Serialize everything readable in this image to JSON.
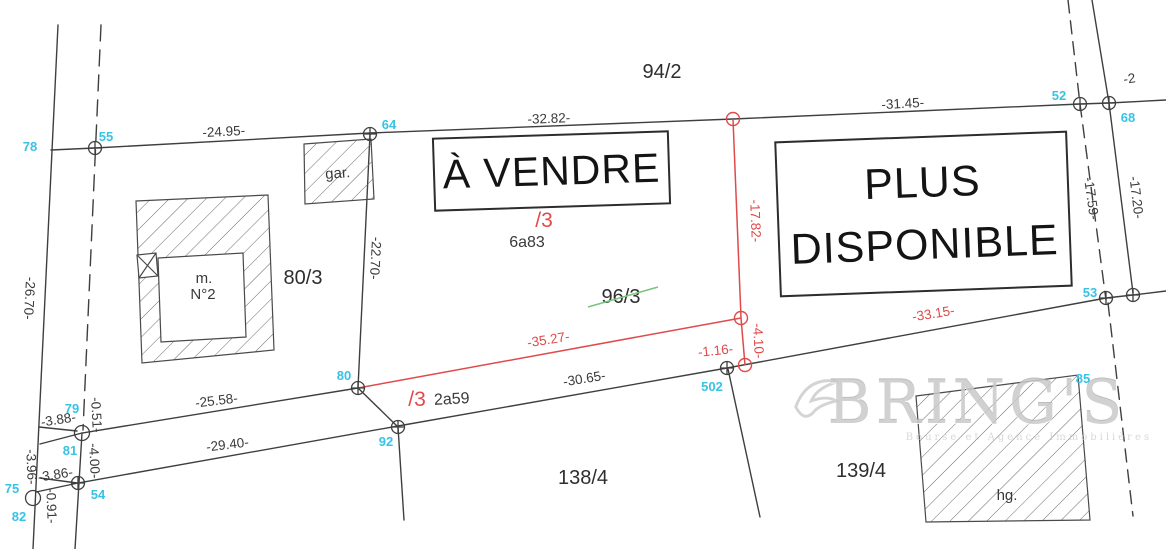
{
  "signs": {
    "for_sale": "À VENDRE",
    "unavailable": "PLUS DISPONIBLE"
  },
  "watermark": {
    "brand": "BRING'S",
    "tagline": "Bourse et Agence Immobilières"
  },
  "parcels": [
    {
      "t": "94/2",
      "x": 662,
      "y": 78
    },
    {
      "t": "80/3",
      "x": 303,
      "y": 284
    },
    {
      "t": "96/3",
      "x": 621,
      "y": 303
    },
    {
      "t": "138/4",
      "x": 583,
      "y": 484
    },
    {
      "t": "139/4",
      "x": 861,
      "y": 477
    }
  ],
  "area_labels": [
    {
      "t": "6a83",
      "x": 527,
      "y": 247
    },
    {
      "t": "2a59",
      "x": 452,
      "y": 404,
      "r": -3
    }
  ],
  "lot_labels": [
    {
      "t": "/3",
      "x": 544,
      "y": 227,
      "s": 22
    },
    {
      "t": "/3",
      "x": 417,
      "y": 406,
      "s": 20
    }
  ],
  "building_labels": [
    {
      "t": "gar.",
      "x": 338,
      "y": 178,
      "r": -4
    },
    {
      "t": "m.",
      "x": 204,
      "y": 283
    },
    {
      "t": "N°2",
      "x": 203,
      "y": 299
    },
    {
      "t": "hg.",
      "x": 1007,
      "y": 500
    }
  ],
  "survey_points": [
    {
      "t": "78",
      "x": 30,
      "y": 151
    },
    {
      "t": "55",
      "x": 106,
      "y": 141
    },
    {
      "t": "64",
      "x": 389,
      "y": 129
    },
    {
      "t": "52",
      "x": 1059,
      "y": 100
    },
    {
      "t": "68",
      "x": 1128,
      "y": 122
    },
    {
      "t": "53",
      "x": 1090,
      "y": 297
    },
    {
      "t": "85",
      "x": 1083,
      "y": 383
    },
    {
      "t": "80",
      "x": 344,
      "y": 380
    },
    {
      "t": "92",
      "x": 386,
      "y": 446
    },
    {
      "t": "502",
      "x": 712,
      "y": 391
    },
    {
      "t": "79",
      "x": 72,
      "y": 413
    },
    {
      "t": "81",
      "x": 70,
      "y": 455
    },
    {
      "t": "75",
      "x": 12,
      "y": 493
    },
    {
      "t": "54",
      "x": 98,
      "y": 499
    },
    {
      "t": "82",
      "x": 19,
      "y": 521
    }
  ],
  "measurements": {
    "black": [
      {
        "t": "-24.95-",
        "x": 224,
        "y": 136,
        "r": -3
      },
      {
        "t": "-32.82-",
        "x": 549,
        "y": 123,
        "r": -2
      },
      {
        "t": "-31.45-",
        "x": 903,
        "y": 108,
        "r": -3
      },
      {
        "t": "-22.70-",
        "x": 371,
        "y": 258,
        "r": 93
      },
      {
        "t": "-26.70-",
        "x": 25,
        "y": 298,
        "r": 93
      },
      {
        "t": "-25.58-",
        "x": 217,
        "y": 405,
        "r": -7
      },
      {
        "t": "-29.40-",
        "x": 228,
        "y": 449,
        "r": -7
      },
      {
        "t": "-30.65-",
        "x": 585,
        "y": 383,
        "r": -9
      },
      {
        "t": "-17.59-",
        "x": 1087,
        "y": 199,
        "r": 82
      },
      {
        "t": "-17.20-",
        "x": 1132,
        "y": 198,
        "r": 83
      },
      {
        "t": "-3.88-",
        "x": 59,
        "y": 424,
        "r": -9
      },
      {
        "t": "-0.51-",
        "x": 92,
        "y": 415,
        "r": 87
      },
      {
        "t": "-4.00-",
        "x": 90,
        "y": 461,
        "r": 87
      },
      {
        "t": "-3.86-",
        "x": 56,
        "y": 479,
        "r": -9
      },
      {
        "t": "-3.96-",
        "x": 27,
        "y": 467,
        "r": 88
      },
      {
        "t": "-0.91-",
        "x": 47,
        "y": 506,
        "r": 88
      },
      {
        "t": "-2",
        "x": 1130,
        "y": 83,
        "r": -8
      }
    ],
    "red": [
      {
        "t": "-17.82-",
        "x": 751,
        "y": 221,
        "r": 88
      },
      {
        "t": "-35.27-",
        "x": 549,
        "y": 344,
        "r": -9
      },
      {
        "t": "-4.10-",
        "x": 754,
        "y": 341,
        "r": 87
      },
      {
        "t": "-1.16-",
        "x": 716,
        "y": 355,
        "r": -6
      },
      {
        "t": "-33.15-",
        "x": 934,
        "y": 318,
        "r": -9
      }
    ]
  },
  "markers": {
    "crossed": [
      [
        95,
        148
      ],
      [
        370,
        134
      ],
      [
        1080,
        104
      ],
      [
        1109,
        103
      ],
      [
        1106,
        298
      ],
      [
        1133,
        295
      ],
      [
        358,
        388
      ],
      [
        398,
        427
      ],
      [
        727,
        368
      ],
      [
        78,
        483
      ]
    ],
    "plain": [
      [
        82,
        433
      ],
      [
        33,
        498
      ]
    ],
    "red": [
      [
        733,
        119
      ],
      [
        741,
        318
      ],
      [
        745,
        365
      ]
    ]
  },
  "colors": {
    "line": "#3f3f3f",
    "measure_red": "#e04a4a",
    "point_cyan": "#38c2e4",
    "strike_green": "#7cc57c",
    "watermark_gray": "#c9c9c9"
  }
}
